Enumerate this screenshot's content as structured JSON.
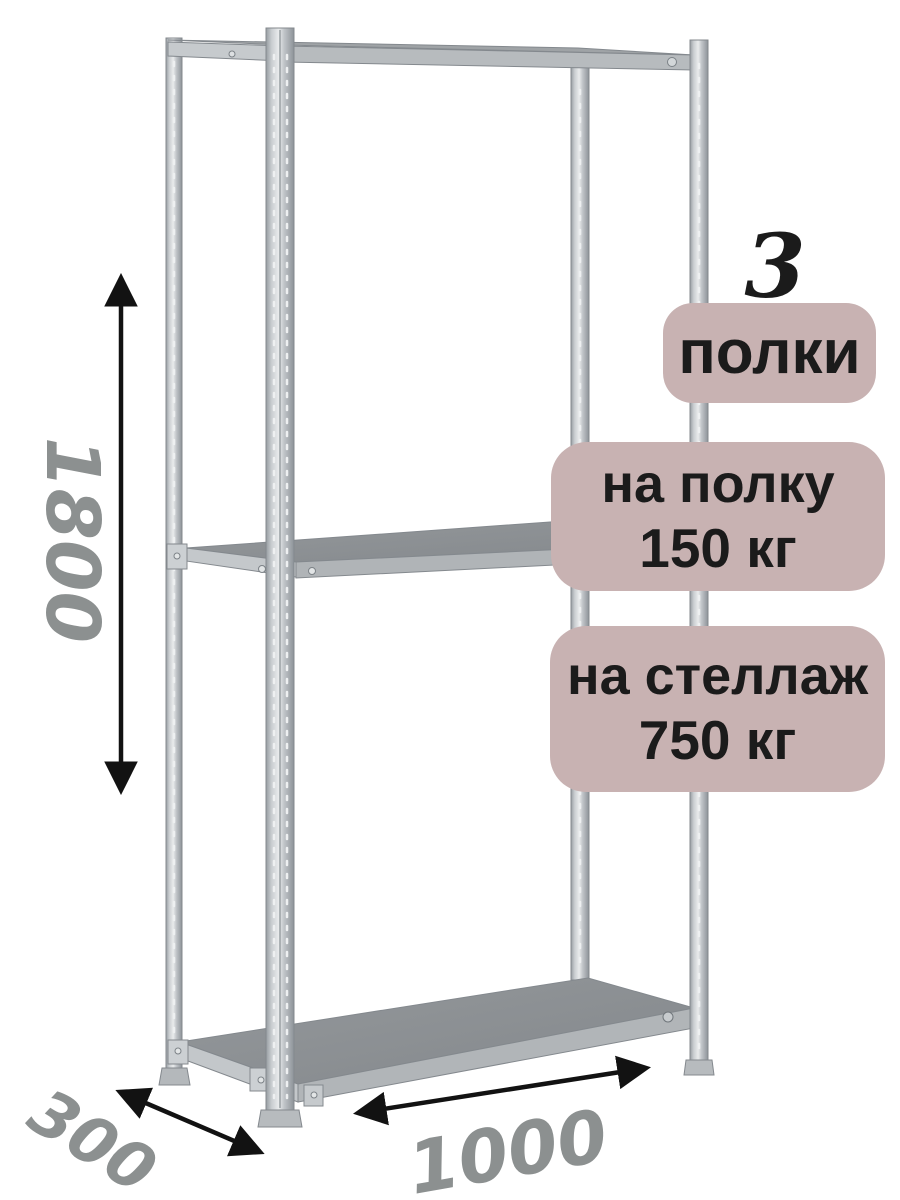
{
  "badges": {
    "shelf_count": "3",
    "shelf_count_label": "полки",
    "per_shelf_capacity": {
      "line1": "на полку",
      "line2": "150 кг"
    },
    "per_rack_capacity": {
      "line1": "на стеллаж",
      "line2": "750 кг"
    }
  },
  "dimensions": {
    "height": "1800",
    "depth": "300",
    "width": "1000"
  },
  "colors": {
    "badge_bg": "#c8b2b2",
    "badge_text": "#1b1b1b",
    "dim_label": "#8c9090",
    "arrow": "#121212"
  }
}
